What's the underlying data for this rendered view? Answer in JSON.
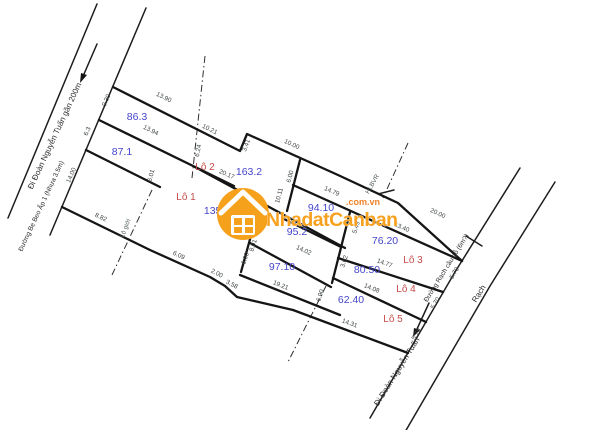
{
  "watermark": {
    "brand": "NhadatCanban",
    "domain": ".com.vn",
    "accent_color": "#F6A11C"
  },
  "roads": {
    "left_road_direction": "Đi Đoàn Nguyễn Tuấn gần 200m",
    "left_road_name": "Đường Bẹ Beo Ấp 1 (Nhựa 3.5m)",
    "right_road_name": "Đường Rạch cầu gỗ (6m?)",
    "canal_label": "Rạch",
    "bottom_direction": "Đi Đoàn Nguyễn Tuấn"
  },
  "corridor_notes": [
    "HLBVR",
    "Lộ giới"
  ],
  "lots": [
    {
      "name": "Lô 1",
      "area": "135.9"
    },
    {
      "name": "Lô 2",
      "area": "163.2"
    },
    {
      "name": "Lô 3",
      "area": "76.20"
    },
    {
      "name": "Lô 4",
      "area": "80.50"
    },
    {
      "name": "Lô 5",
      "area": "62.40"
    }
  ],
  "unnamed_parcel_areas": [
    "86.3",
    "87.1",
    "94.10",
    "95.2",
    "97.10"
  ],
  "dimensions": [
    "9.30",
    "13.90",
    "10.21",
    "3.41",
    "10.00",
    "13.94",
    "6.3",
    "6.24",
    "14.00",
    "6.01",
    "20.17",
    "8.82",
    "6.09",
    "2.00",
    "3.58",
    "8.01",
    "6.00",
    "6.00",
    "10.11",
    "14.79",
    "20.00",
    "5.49",
    "3.62",
    "14.02",
    "13.40",
    "14.77",
    "14.08",
    "19.21",
    "6.90",
    "14.31",
    "5.70",
    "5.70",
    "5.70"
  ],
  "plot": {
    "texts": [
      {
        "t": "9.30",
        "x": 108,
        "y": 101,
        "r": -66,
        "c": "dim"
      },
      {
        "t": "13.90",
        "x": 163,
        "y": 99,
        "r": 26,
        "c": "dim"
      },
      {
        "t": "10.21",
        "x": 209,
        "y": 131,
        "r": 26,
        "c": "dim"
      },
      {
        "t": "3.41",
        "x": 248,
        "y": 146,
        "r": -70,
        "c": "dim"
      },
      {
        "t": "10.00",
        "x": 291,
        "y": 146,
        "r": 25,
        "c": "dim"
      },
      {
        "t": "13.94",
        "x": 150,
        "y": 132,
        "r": 26,
        "c": "dim"
      },
      {
        "t": "6.3",
        "x": 89,
        "y": 132,
        "r": -66,
        "c": "dim"
      },
      {
        "t": "6.24",
        "x": 200,
        "y": 151,
        "r": -78,
        "c": "dim"
      },
      {
        "t": "14.00",
        "x": 73,
        "y": 176,
        "r": -66,
        "c": "dim"
      },
      {
        "t": "6.01",
        "x": 153,
        "y": 176,
        "r": -75,
        "c": "dim"
      },
      {
        "t": "20.17",
        "x": 226,
        "y": 176,
        "r": 23,
        "c": "dim"
      },
      {
        "t": "8.82",
        "x": 100,
        "y": 219,
        "r": 25,
        "c": "dim"
      },
      {
        "t": "6.09",
        "x": 178,
        "y": 257,
        "r": 25,
        "c": "dim"
      },
      {
        "t": "2.00",
        "x": 216,
        "y": 275,
        "r": 27,
        "c": "dim"
      },
      {
        "t": "3.58",
        "x": 231,
        "y": 286,
        "r": 27,
        "c": "dim"
      },
      {
        "t": "8.01",
        "x": 255,
        "y": 246,
        "r": -72,
        "c": "dim"
      },
      {
        "t": "6.00",
        "x": 247,
        "y": 259,
        "r": -72,
        "c": "dim"
      },
      {
        "t": "6.00",
        "x": 292,
        "y": 177,
        "r": -75,
        "c": "dim"
      },
      {
        "t": "10.11",
        "x": 281,
        "y": 196,
        "r": -75,
        "c": "dim"
      },
      {
        "t": "14.79",
        "x": 331,
        "y": 193,
        "r": 24,
        "c": "dim"
      },
      {
        "t": "20.00",
        "x": 437,
        "y": 215,
        "r": 25,
        "c": "dim"
      },
      {
        "t": "5.49",
        "x": 358,
        "y": 228,
        "r": -72,
        "c": "dim"
      },
      {
        "t": "3.62",
        "x": 346,
        "y": 262,
        "r": -72,
        "c": "dim"
      },
      {
        "t": "14.02",
        "x": 303,
        "y": 252,
        "r": 24,
        "c": "dim"
      },
      {
        "t": "13.40",
        "x": 401,
        "y": 229,
        "r": 24,
        "c": "dim"
      },
      {
        "t": "14.77",
        "x": 384,
        "y": 265,
        "r": 20,
        "c": "dim"
      },
      {
        "t": "14.08",
        "x": 371,
        "y": 290,
        "r": 22,
        "c": "dim"
      },
      {
        "t": "19.21",
        "x": 280,
        "y": 287,
        "r": 22,
        "c": "dim"
      },
      {
        "t": "6.90",
        "x": 322,
        "y": 296,
        "r": -72,
        "c": "dim"
      },
      {
        "t": "14.31",
        "x": 349,
        "y": 325,
        "r": 20,
        "c": "dim"
      },
      {
        "t": "5.70",
        "x": 456,
        "y": 274,
        "r": -60,
        "c": "dim"
      },
      {
        "t": "5.70",
        "x": 437,
        "y": 304,
        "r": -60,
        "c": "dim"
      },
      {
        "t": "5.70",
        "x": 418,
        "y": 335,
        "r": -60,
        "c": "dim"
      },
      {
        "t": "86.3",
        "x": 137,
        "y": 120,
        "r": 0,
        "c": "area"
      },
      {
        "t": "87.1",
        "x": 122,
        "y": 155,
        "r": 0,
        "c": "area"
      },
      {
        "t": "163.2",
        "x": 249,
        "y": 175,
        "r": 0,
        "c": "area"
      },
      {
        "t": "135.9",
        "x": 217,
        "y": 214,
        "r": 0,
        "c": "area"
      },
      {
        "t": "94.10",
        "x": 321,
        "y": 211,
        "r": 0,
        "c": "area"
      },
      {
        "t": "95.2",
        "x": 297,
        "y": 235,
        "r": 0,
        "c": "area"
      },
      {
        "t": "76.20",
        "x": 385,
        "y": 244,
        "r": 0,
        "c": "area"
      },
      {
        "t": "97.10",
        "x": 282,
        "y": 270,
        "r": 0,
        "c": "area"
      },
      {
        "t": "80.50",
        "x": 367,
        "y": 273,
        "r": 0,
        "c": "area"
      },
      {
        "t": "62.40",
        "x": 351,
        "y": 303,
        "r": 0,
        "c": "area"
      },
      {
        "t": "Lô 2",
        "x": 205,
        "y": 170,
        "r": 0,
        "c": "lot"
      },
      {
        "t": "Lô 1",
        "x": 186,
        "y": 200,
        "r": 0,
        "c": "lot"
      },
      {
        "t": "Lô 3",
        "x": 413,
        "y": 263,
        "r": 0,
        "c": "lot"
      },
      {
        "t": "Lô 4",
        "x": 406,
        "y": 292,
        "r": 0,
        "c": "lot"
      },
      {
        "t": "Lô 5",
        "x": 393,
        "y": 322,
        "r": 0,
        "c": "lot"
      },
      {
        "t": "Đi Đoàn Nguyễn Tuấn gần 200m",
        "x": 57,
        "y": 137,
        "r": -65,
        "c": "road"
      },
      {
        "t": "Đường Bẹ Beo Ấp 1 (Nhựa 3.5m)",
        "x": 43,
        "y": 207,
        "r": -65,
        "c": "road-sm"
      },
      {
        "t": "Đường Rạch cầu gỗ (6m?)",
        "x": 448,
        "y": 269,
        "r": -58,
        "c": "road-sm"
      },
      {
        "t": "Rạch",
        "x": 481,
        "y": 295,
        "r": -58,
        "c": "road"
      },
      {
        "t": "Đi Đoàn Nguyễn Tuấn",
        "x": 399,
        "y": 373,
        "r": -58,
        "c": "road"
      },
      {
        "t": "HLBVR",
        "x": 374,
        "y": 185,
        "r": -60,
        "c": "corridor"
      },
      {
        "t": "Lộ giới",
        "x": 127,
        "y": 229,
        "r": -68,
        "c": "corridor"
      }
    ]
  }
}
